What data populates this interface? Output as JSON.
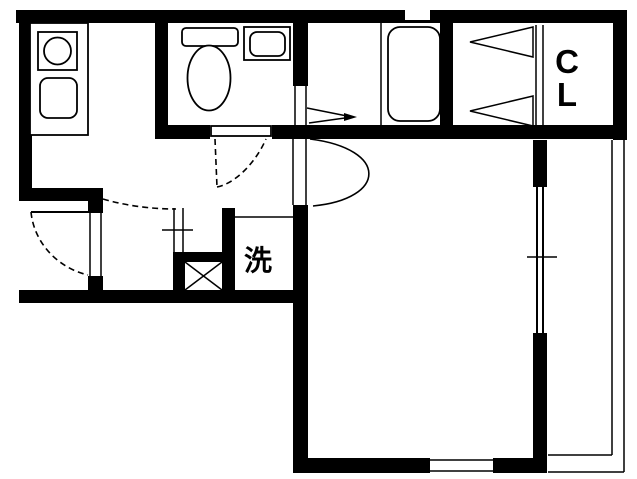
{
  "document": {
    "type": "apartment-floor-plan",
    "orientation": "plan-view"
  },
  "labels": {
    "laundry": "洗",
    "closet_line1": "C",
    "closet_line2": "L"
  },
  "colors": {
    "wall": "#000000",
    "background": "#ffffff",
    "line": "#000000"
  },
  "fixtures": [
    "kitchen-counter",
    "stove-burner",
    "kitchen-sink",
    "toilet",
    "hand-basin",
    "bathtub",
    "washing-machine-space",
    "pipe-shaft",
    "closet",
    "entrance-door",
    "toilet-door",
    "living-room-door",
    "closet-bifold-door",
    "bath-folding-door",
    "window-right",
    "window-bottom",
    "window-top",
    "window-entry",
    "balcony"
  ]
}
